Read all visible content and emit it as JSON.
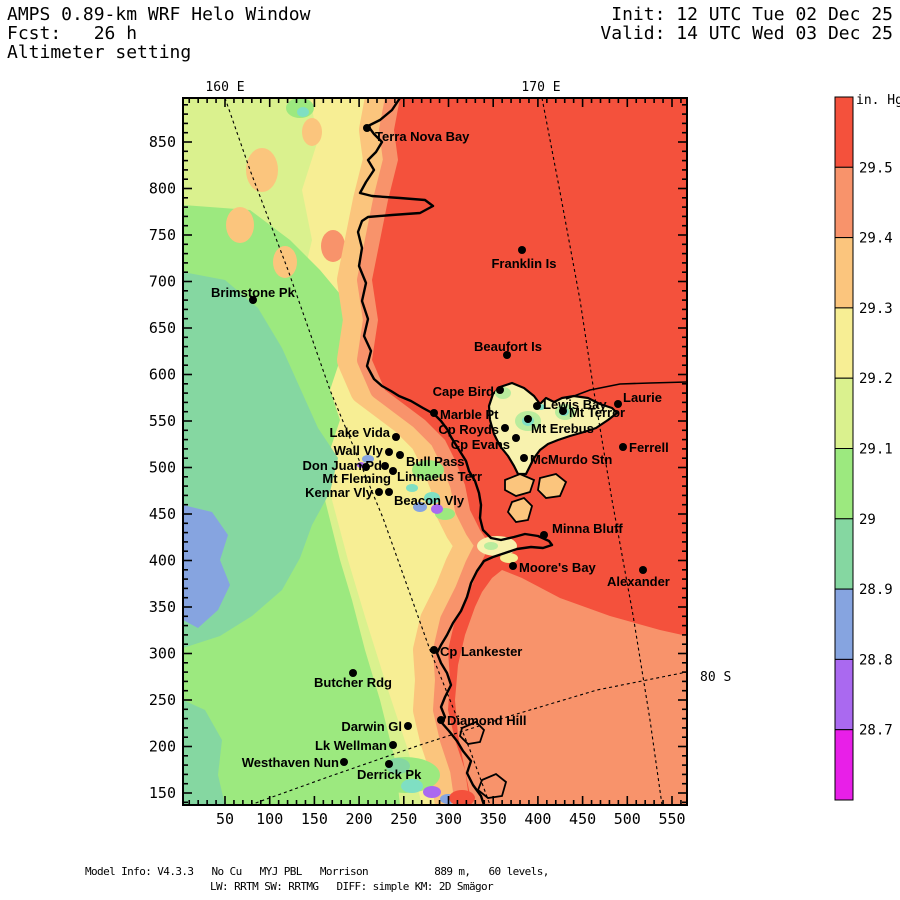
{
  "header": {
    "title": "AMPS 0.89-km WRF Helo Window",
    "fcst": "Fcst:   26 h",
    "field": "Altimeter setting",
    "init": "Init: 12 UTC Tue 02 Dec 25",
    "valid": "Valid: 14 UTC Wed 03 Dec 25"
  },
  "footer": {
    "line1": "Model Info: V4.3.3   No Cu   MYJ PBL   Morrison           889 m,   60 levels,",
    "line2": "LW: RRTM SW: RRTMG   DIFF: simple KM: 2D Smägor"
  },
  "colorbar": {
    "title": "in. Hg",
    "tick_labels": [
      "29.5",
      "29.4",
      "29.3",
      "29.2",
      "29.1",
      "29",
      "28.9",
      "28.8",
      "28.7"
    ],
    "segments_top_to_bottom": [
      "red",
      "salmon",
      "orange",
      "yellow",
      "yellowgreen",
      "green",
      "seagreen",
      "blue",
      "purple",
      "magenta"
    ]
  },
  "axes": {
    "x_tick_labels": [
      50,
      100,
      150,
      200,
      250,
      300,
      350,
      400,
      450,
      500,
      550
    ],
    "y_tick_labels": [
      150,
      200,
      250,
      300,
      350,
      400,
      450,
      500,
      550,
      600,
      650,
      700,
      750,
      800,
      850
    ],
    "minor_step": 10
  },
  "geo_labels": [
    {
      "text": "160 E",
      "x": 225,
      "y": 91,
      "anchor": "middle"
    },
    {
      "text": "170 E",
      "x": 541,
      "y": 91,
      "anchor": "middle"
    },
    {
      "text": "80 S",
      "x": 700,
      "y": 681,
      "anchor": "start"
    }
  ],
  "stations": [
    {
      "name": "Terra Nova Bay",
      "dot": [
        367,
        128
      ],
      "label": [
        375,
        141
      ],
      "anchor": "start"
    },
    {
      "name": "Franklin Is",
      "dot": [
        522,
        250
      ],
      "label": [
        524,
        268
      ],
      "anchor": "middle"
    },
    {
      "name": "Brimstone Pk",
      "dot": [
        253,
        300
      ],
      "label": [
        211,
        297
      ],
      "anchor": "start"
    },
    {
      "name": "Beaufort Is",
      "dot": [
        507,
        355
      ],
      "label": [
        508,
        351
      ],
      "anchor": "middle"
    },
    {
      "name": "Cape Bird",
      "dot": [
        500,
        390
      ],
      "label": [
        494,
        396
      ],
      "anchor": "end"
    },
    {
      "name": "Marble Pt",
      "dot": [
        434,
        413
      ],
      "label": [
        440,
        419
      ],
      "anchor": "start"
    },
    {
      "name": "Lewis Bay",
      "dot": [
        537,
        406
      ],
      "label": [
        543,
        409
      ],
      "anchor": "start"
    },
    {
      "name": "Mt Terror",
      "dot": [
        563,
        411
      ],
      "label": [
        569,
        417
      ],
      "anchor": "start"
    },
    {
      "name": "Laurie",
      "dot": [
        618,
        404
      ],
      "label": [
        623,
        402
      ],
      "anchor": "start"
    },
    {
      "name": "Cp Royds",
      "dot": [
        505,
        428
      ],
      "label": [
        499,
        434
      ],
      "anchor": "end"
    },
    {
      "name": "Mt Erebus",
      "dot": [
        528,
        419
      ],
      "label": [
        531,
        433
      ],
      "anchor": "start"
    },
    {
      "name": "Cp Evans",
      "dot": [
        516,
        438
      ],
      "label": [
        510,
        449
      ],
      "anchor": "end"
    },
    {
      "name": "McMurdo Stn",
      "dot": [
        524,
        458
      ],
      "label": [
        530,
        464
      ],
      "anchor": "start"
    },
    {
      "name": "Ferrell",
      "dot": [
        623,
        447
      ],
      "label": [
        629,
        452
      ],
      "anchor": "start"
    },
    {
      "name": "Lake Vida",
      "dot": [
        396,
        437
      ],
      "label": [
        390,
        437
      ],
      "anchor": "end"
    },
    {
      "name": "Wall Vly",
      "dot": [
        389,
        452
      ],
      "label": [
        383,
        455
      ],
      "anchor": "end"
    },
    {
      "name": "Bull Pass",
      "dot": [
        400,
        455
      ],
      "label": [
        406,
        466
      ],
      "anchor": "start"
    },
    {
      "name": "Don Juan Pd",
      "dot": [
        385,
        466
      ],
      "label": [
        382,
        470
      ],
      "anchor": "end"
    },
    {
      "name": "Linnaeus Terr",
      "dot": [
        393,
        471
      ],
      "label": [
        397,
        481
      ],
      "anchor": "start"
    },
    {
      "name": "Mt Fleming",
      "dot": [
        366,
        467
      ],
      "label": [
        391,
        483
      ],
      "anchor": "end"
    },
    {
      "name": "Kennar Vly",
      "dot": [
        379,
        492
      ],
      "label": [
        373,
        497
      ],
      "anchor": "end"
    },
    {
      "name": "Beacon Vly",
      "dot": [
        389,
        492
      ],
      "label": [
        394,
        505
      ],
      "anchor": "start"
    },
    {
      "name": "Minna Bluff",
      "dot": [
        544,
        535
      ],
      "label": [
        552,
        533
      ],
      "anchor": "start"
    },
    {
      "name": "Moore's Bay",
      "dot": [
        513,
        566
      ],
      "label": [
        519,
        572
      ],
      "anchor": "start"
    },
    {
      "name": "Alexander",
      "dot": [
        643,
        570
      ],
      "label": [
        607,
        586
      ],
      "anchor": "start"
    },
    {
      "name": "Cp Lankester",
      "dot": [
        434,
        650
      ],
      "label": [
        440,
        656
      ],
      "anchor": "start"
    },
    {
      "name": "Butcher Rdg",
      "dot": [
        353,
        673
      ],
      "label": [
        314,
        687
      ],
      "anchor": "start"
    },
    {
      "name": "Darwin Gl",
      "dot": [
        408,
        726
      ],
      "label": [
        402,
        731
      ],
      "anchor": "end"
    },
    {
      "name": "Diamond Hill",
      "dot": [
        441,
        720
      ],
      "label": [
        447,
        725
      ],
      "anchor": "start"
    },
    {
      "name": "Lk Wellman",
      "dot": [
        393,
        745
      ],
      "label": [
        387,
        750
      ],
      "anchor": "end"
    },
    {
      "name": "Westhaven Nun",
      "dot": [
        344,
        762
      ],
      "label": [
        339,
        767
      ],
      "anchor": "end"
    },
    {
      "name": "Derrick Pk",
      "dot": [
        389,
        764
      ],
      "label": [
        357,
        779
      ],
      "anchor": "start"
    }
  ],
  "palette": {
    "red": "#f4513c",
    "salmon": "#f8936b",
    "orange": "#fbc57d",
    "yellow": "#f7ee94",
    "yellowgreen": "#daf18e",
    "green": "#9ce97f",
    "seagreen": "#85d7a1",
    "blue": "#86a4e0",
    "purple": "#aa69f0",
    "magenta": "#e81fe8",
    "cream": "#f8f2ae",
    "cyan": "#7fdfc3",
    "island_green": "#b9ec9d"
  }
}
